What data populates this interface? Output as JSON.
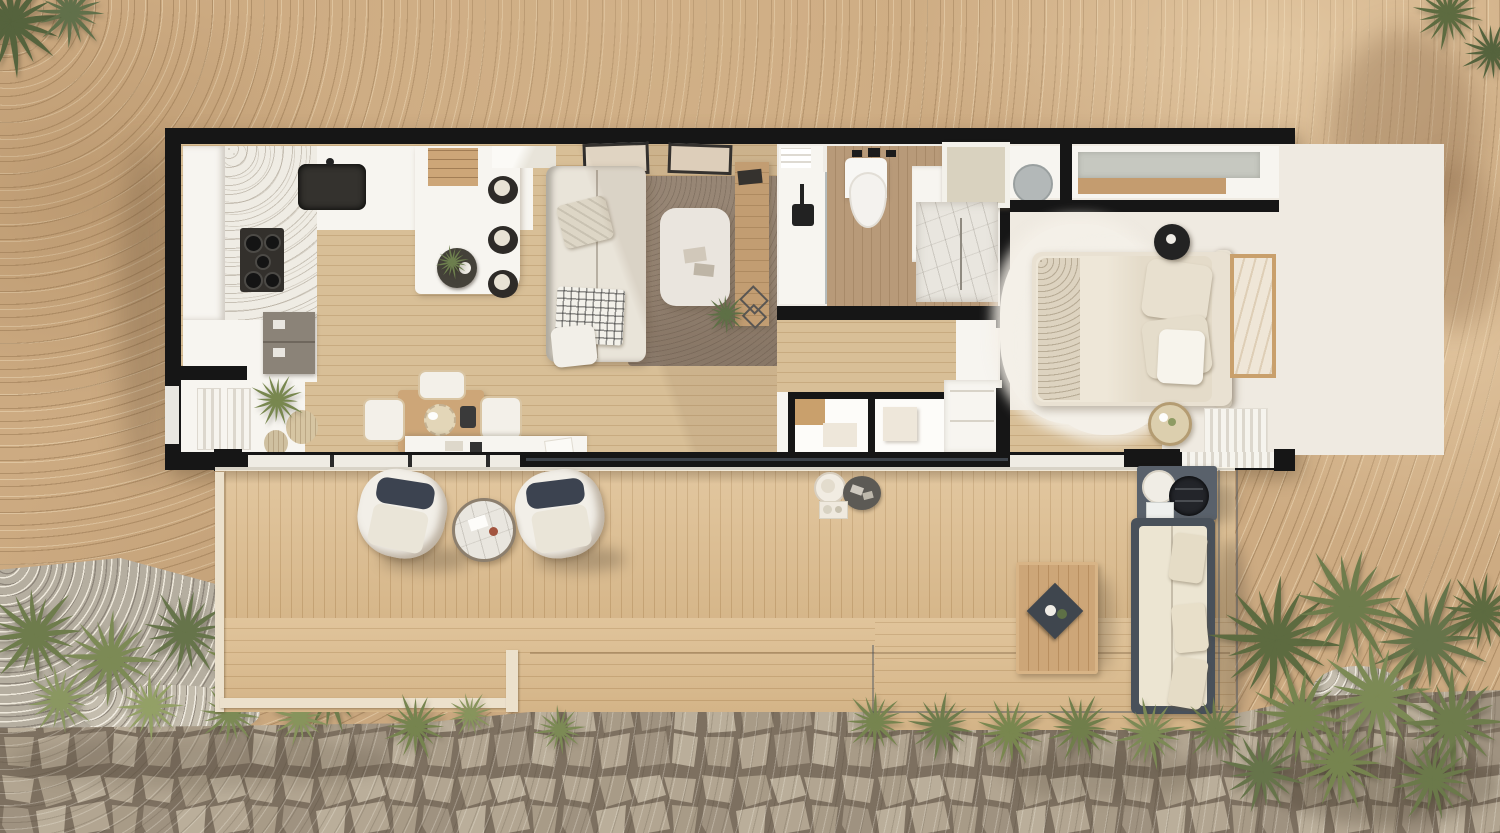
{
  "scene": {
    "description": "Top-down 3D architectural render of a rectangular tiny house (container-home style) with a full-length wooden deck, set on a sandy desert lot with a flagstone path, gravel strip and palm shrubs",
    "view": "top-down orthographic",
    "visible_text": "none"
  },
  "palette": {
    "wall": "#161616",
    "white_surface": "#f7f5f0",
    "trim_cream": "#ece1cc",
    "floor_wood": "#d8bf97",
    "floor_line": "#c8ab80",
    "bath_floor": "#b89a79",
    "bath_line": "#a88a69",
    "deck_wood": "#ddbe91",
    "deck_line": "#c9a778",
    "dirt": "#cdab82",
    "gravel": "#b5aea0",
    "pavement": "#a99c88",
    "pavement_crack": "#7d7060",
    "stone_a": "#b2a591",
    "stone_b": "#a89b87",
    "stone_c": "#baae9a",
    "stone_d": "#9f9280",
    "rug_living": "#9c8c7c",
    "rug_shag": "#f4f0e8",
    "sofa_cream": "#e9e4d9",
    "cushion_navy": "#3c4350",
    "wood_furniture": "#cda678",
    "outdoor_frame": "#49515a",
    "outdoor_cushion": "#ece5d2",
    "dark_appliance": "#33302c",
    "marble": "#e9e6df",
    "glass": "#7f8a93"
  },
  "site": {
    "ground": "sand-dirt",
    "paving": "flagstone-crazy-paving",
    "gravel_strip": true,
    "vegetation_clusters": [
      {
        "x": 35,
        "y": 635,
        "s": 1.2,
        "color": "#6e7c4c"
      },
      {
        "x": 110,
        "y": 658,
        "s": 1.15,
        "color": "#7c8a55"
      },
      {
        "x": 185,
        "y": 632,
        "s": 1.05,
        "color": "#66744a"
      },
      {
        "x": 255,
        "y": 668,
        "s": 1.25,
        "color": "#79874f"
      },
      {
        "x": 330,
        "y": 692,
        "s": 1.0,
        "color": "#6e7c4c"
      },
      {
        "x": 60,
        "y": 700,
        "s": 0.85,
        "color": "#8a9761"
      },
      {
        "x": 150,
        "y": 706,
        "s": 0.8,
        "color": "#93a066"
      },
      {
        "x": 230,
        "y": 714,
        "s": 0.75,
        "color": "#7c8a55"
      },
      {
        "x": 300,
        "y": 718,
        "s": 0.7,
        "color": "#87945c"
      },
      {
        "x": 415,
        "y": 726,
        "s": 0.8,
        "color": "#76844f",
        "front": true
      },
      {
        "x": 470,
        "y": 714,
        "s": 0.55,
        "color": "#87945c",
        "front": true
      },
      {
        "x": 560,
        "y": 730,
        "s": 0.6,
        "color": "#7c8a55",
        "front": true
      },
      {
        "x": 875,
        "y": 722,
        "s": 0.75,
        "color": "#76844f",
        "front": true
      },
      {
        "x": 940,
        "y": 726,
        "s": 0.8,
        "color": "#6e7c4c",
        "front": true
      },
      {
        "x": 1010,
        "y": 732,
        "s": 0.85,
        "color": "#79874f",
        "front": true
      },
      {
        "x": 1080,
        "y": 728,
        "s": 0.85,
        "color": "#707e4b",
        "front": true
      },
      {
        "x": 1150,
        "y": 734,
        "s": 0.85,
        "color": "#7c8a55",
        "front": true
      },
      {
        "x": 1215,
        "y": 728,
        "s": 0.8,
        "color": "#6e7c4c",
        "front": true
      },
      {
        "x": 1275,
        "y": 640,
        "s": 1.55,
        "color": "#5d6b40",
        "front": true
      },
      {
        "x": 1350,
        "y": 607,
        "s": 1.45,
        "color": "#6e7c4c",
        "front": true
      },
      {
        "x": 1428,
        "y": 640,
        "s": 1.5,
        "color": "#66744a",
        "front": true
      },
      {
        "x": 1300,
        "y": 716,
        "s": 1.3,
        "color": "#76844f",
        "front": true
      },
      {
        "x": 1378,
        "y": 697,
        "s": 1.45,
        "color": "#7c8a55",
        "front": true
      },
      {
        "x": 1452,
        "y": 722,
        "s": 1.3,
        "color": "#6e7c4c",
        "front": true
      },
      {
        "x": 1482,
        "y": 612,
        "s": 1.0,
        "color": "#5d6b40",
        "front": true
      },
      {
        "x": 1262,
        "y": 772,
        "s": 1.0,
        "color": "#66744a",
        "front": true
      },
      {
        "x": 1340,
        "y": 762,
        "s": 1.15,
        "color": "#76844f",
        "front": true
      },
      {
        "x": 1432,
        "y": 778,
        "s": 1.05,
        "color": "#6b794a",
        "front": true
      },
      {
        "x": 12,
        "y": 22,
        "s": 1.35,
        "color": "#55633d"
      },
      {
        "x": 70,
        "y": 12,
        "s": 0.9,
        "color": "#61704a"
      },
      {
        "x": 1448,
        "y": 14,
        "s": 0.85,
        "color": "#5d6b40"
      },
      {
        "x": 1492,
        "y": 52,
        "s": 0.75,
        "color": "#55633d"
      },
      {
        "x": 277,
        "y": 400,
        "s": 0.65,
        "color": "#78874f",
        "front": true
      },
      {
        "x": 452,
        "y": 262,
        "s": 0.4,
        "color": "#6d7f4e",
        "front": true
      },
      {
        "x": 726,
        "y": 314,
        "s": 0.5,
        "color": "#5e7046",
        "front": true
      }
    ]
  },
  "house": {
    "style": "container-tiny-home",
    "rooms": [
      {
        "name": "kitchen",
        "items": [
          "tall-cabinets",
          "oven",
          "gas-cooktop",
          "black-sink",
          "peninsula-counter",
          "bar-stools",
          "loft-stairs",
          "serving-tray-with-plant",
          "base-cabinet"
        ]
      },
      {
        "name": "dining-nook",
        "items": [
          "wood-dining-table",
          "four-chairs",
          "potted-plants",
          "window-sideboard"
        ]
      },
      {
        "name": "living-room",
        "items": [
          "l-shaped-sofa",
          "area-rug",
          "white-coffee-table",
          "console-table",
          "floor-lamp",
          "two-wall-art-frames",
          "house-plant",
          "wire-deco-baskets"
        ]
      },
      {
        "name": "bathroom",
        "items": [
          "wall-basin",
          "wall-faucets",
          "walk-in-shower",
          "shower-head",
          "marble-shower-tray",
          "vanity-column",
          "mirror-cabinet",
          "towel-shelf"
        ]
      },
      {
        "name": "hallway",
        "items": [
          "storage-closets",
          "appliance-cabinets"
        ]
      },
      {
        "name": "bedroom",
        "items": [
          "double-bed",
          "pillows",
          "shag-rug",
          "black-nightstand",
          "flower-side-table",
          "wall-art",
          "wardrobe-gray-sliders",
          "utility-closet-boiler"
        ]
      }
    ]
  },
  "deck": {
    "zones": [
      "upper-walkway-vertical-planks",
      "lower-terrace-horizontal-planks",
      "right-terrace-with-glass-railing"
    ],
    "items": [
      "lounge-chair-left",
      "lounge-chair-right",
      "round-side-table",
      "serving-plate",
      "round-tray",
      "small-tray",
      "grill-cart",
      "outdoor-sofa",
      "outdoor-coffee-table-with-tray"
    ],
    "railing": "glass"
  }
}
